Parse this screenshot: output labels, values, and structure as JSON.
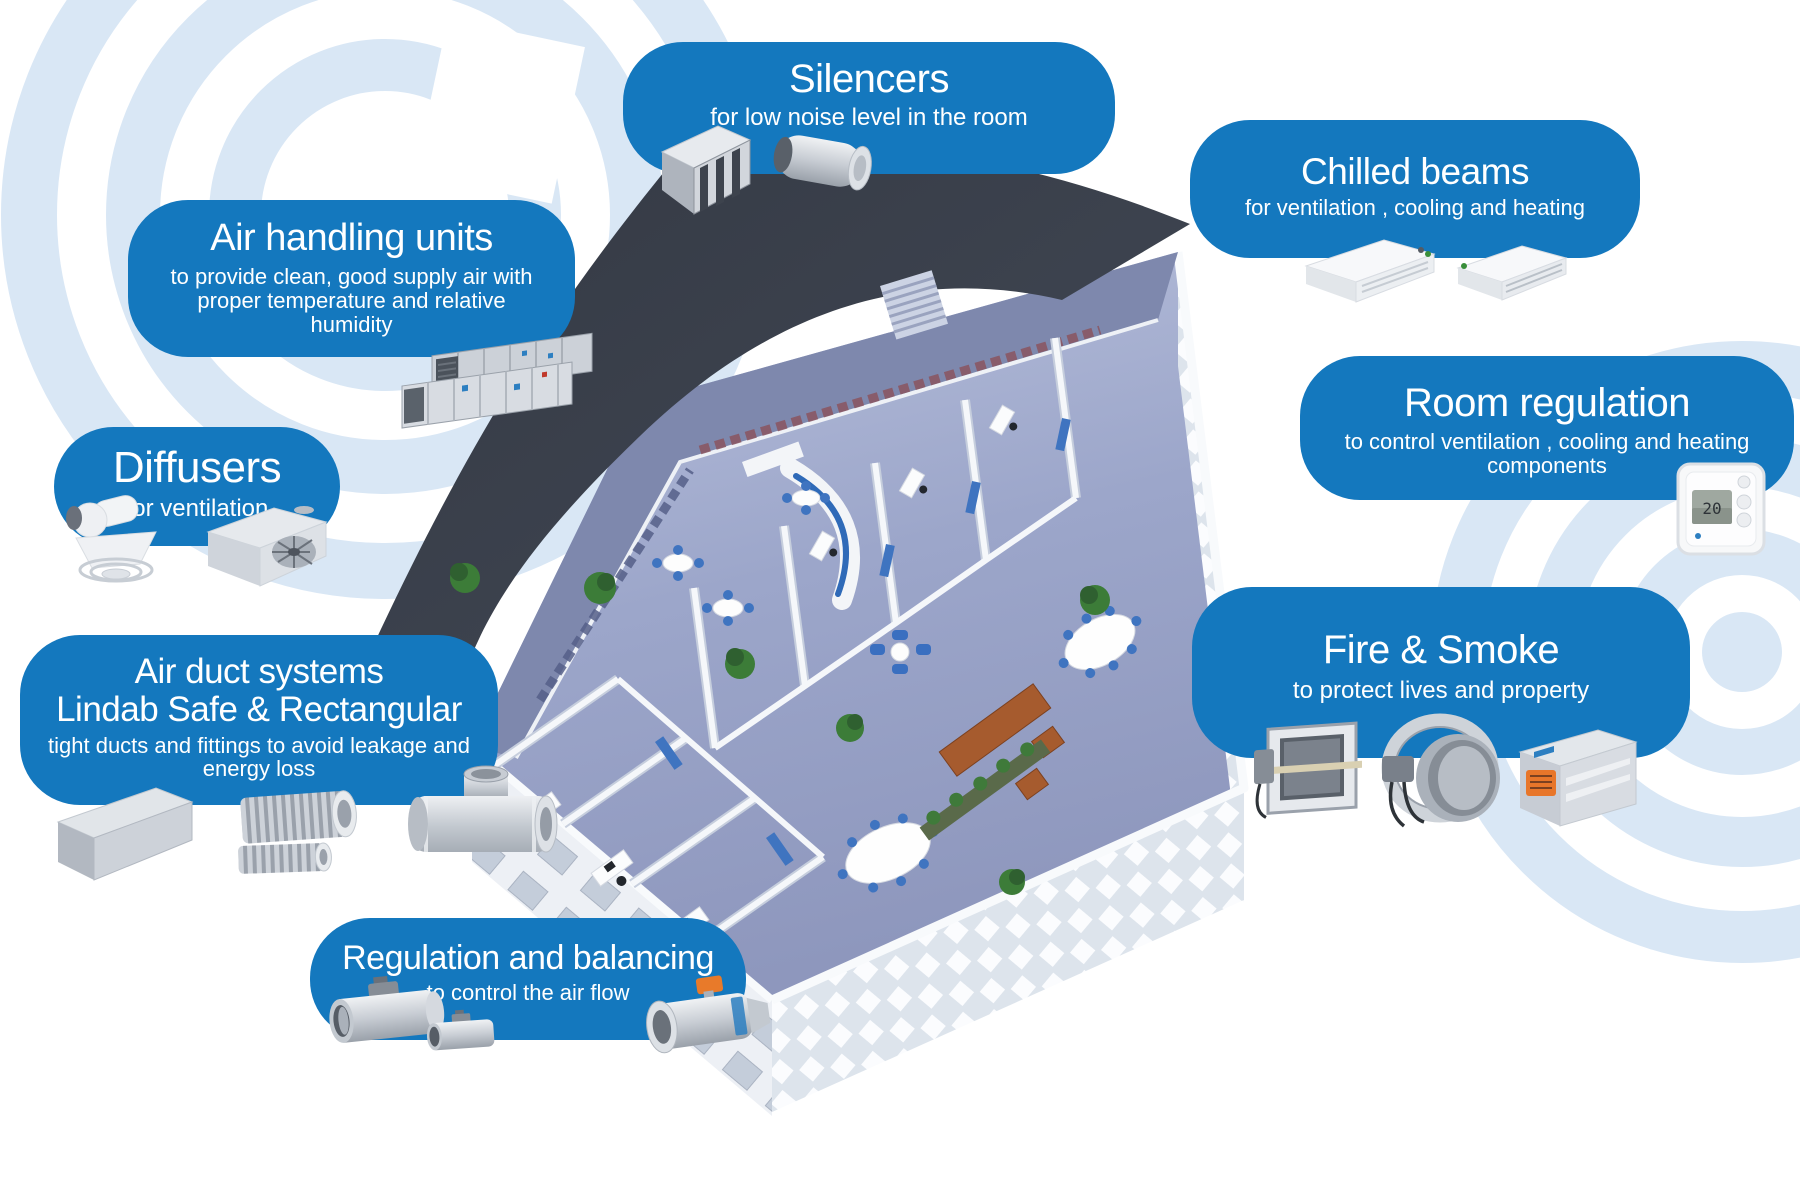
{
  "colors": {
    "callout_blue": "#1478be",
    "roof_dark": "#3a3f48",
    "floor_lavender": "#9aa4c8",
    "arc_light_blue": "#d9e7f5"
  },
  "callouts": {
    "silencers": {
      "title": "Silencers",
      "subtitle": "for low noise level in the room"
    },
    "chilled_beams": {
      "title": "Chilled beams",
      "subtitle": "for ventilation , cooling and heating"
    },
    "air_handling_units": {
      "title": "Air handling units",
      "subtitle": "to provide clean, good supply air with proper temperature and relative humidity"
    },
    "diffusers": {
      "title": "Diffusers",
      "subtitle": "for ventilation"
    },
    "air_duct_systems": {
      "title_line1": "Air duct systems",
      "title_line2": "Lindab Safe & Rectangular",
      "subtitle": "tight ducts and fittings to avoid leakage and energy loss"
    },
    "regulation_and_balancing": {
      "title": "Regulation and balancing",
      "subtitle": "to control the air flow"
    },
    "room_regulation": {
      "title": "Room regulation",
      "subtitle": "to control ventilation , cooling and heating components"
    },
    "fire_and_smoke": {
      "title": "Fire & Smoke",
      "subtitle": "to protect lives and property"
    }
  },
  "thermostat": {
    "display": "20"
  },
  "icons": {
    "product_images": [
      "splitter-silencer",
      "circular-silencer",
      "chilled-beam-cassette-1",
      "chilled-beam-cassette-2",
      "air-handling-unit",
      "round-diffuser",
      "square-diffuser",
      "rectangular-duct",
      "flexible-ducts",
      "tee-fitting",
      "damper-large",
      "damper-small",
      "iris-damper",
      "fire-damper-rectangular",
      "fire-damper-round",
      "fire-damper-unit",
      "room-thermostat"
    ]
  }
}
